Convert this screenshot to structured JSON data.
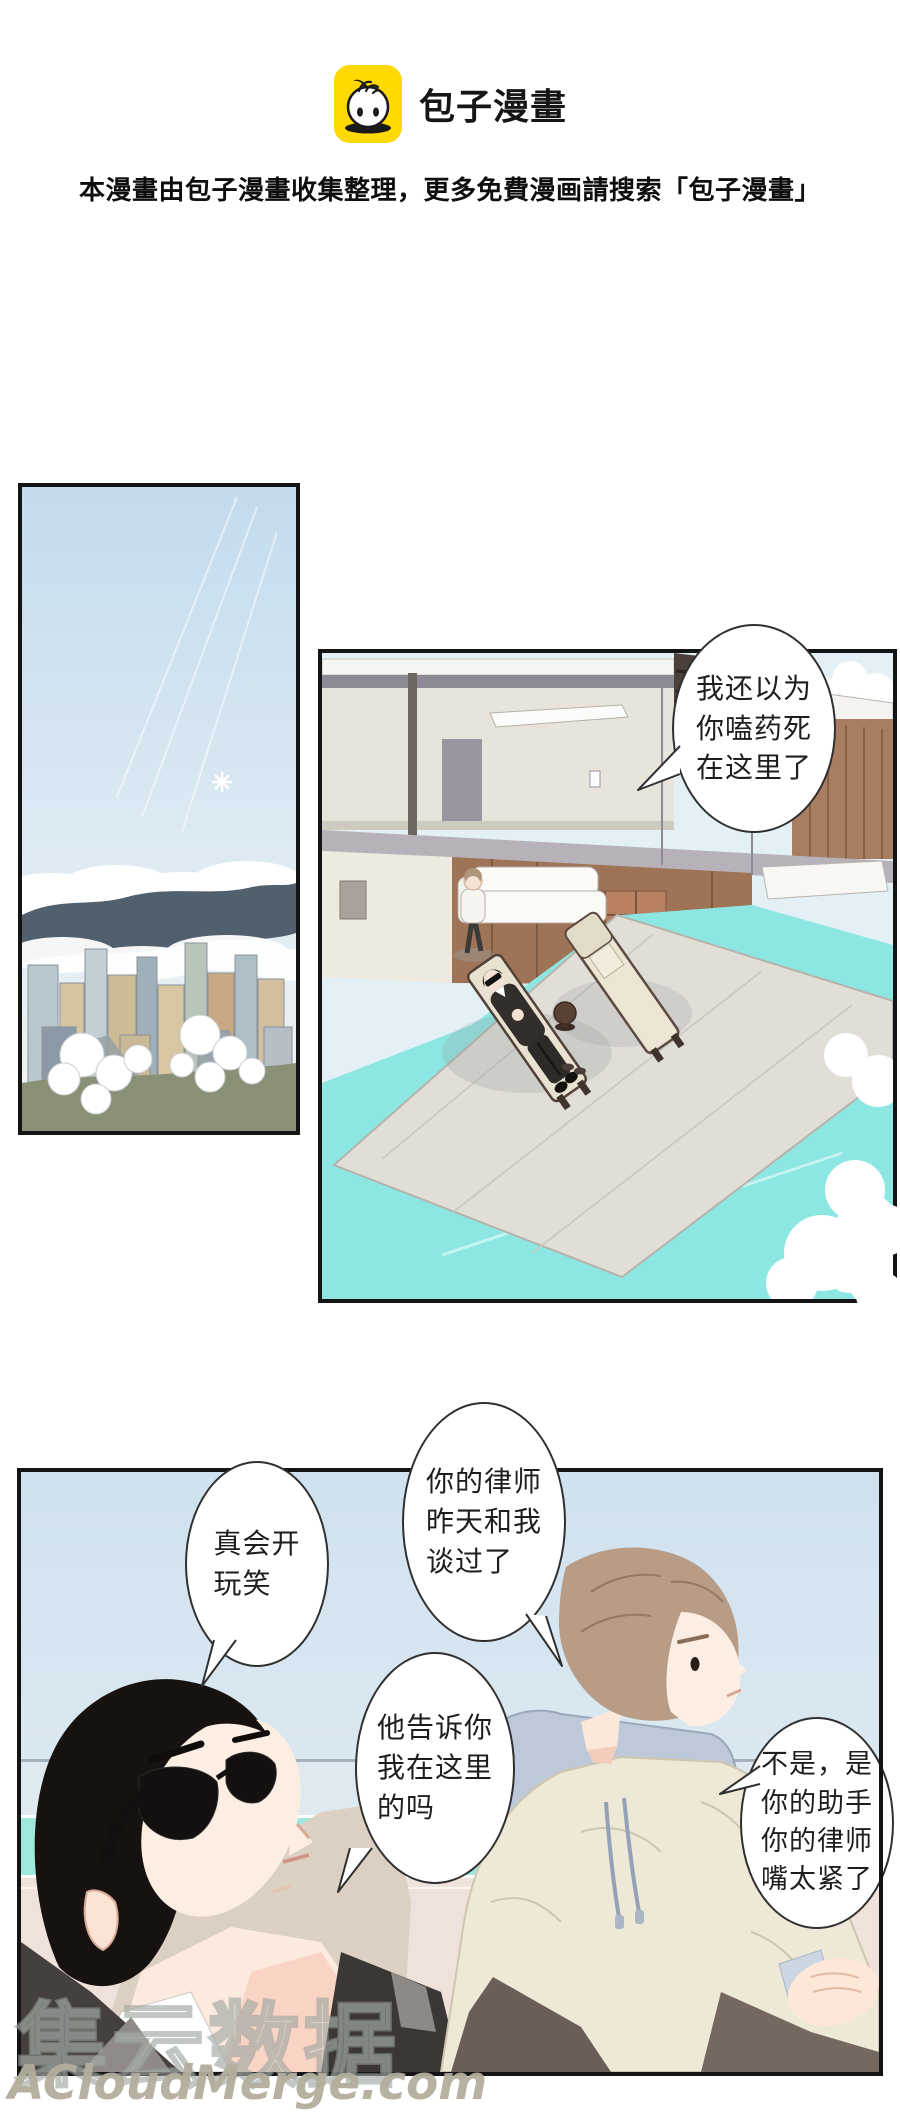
{
  "header": {
    "brand": "包子漫畫",
    "logo_icon": "baozi-mascot-icon",
    "logo_bg": "#FFD900",
    "subtitle": "本漫畫由包子漫畫收集整理，更多免費漫画請搜索「包子漫畫」"
  },
  "bubbles": {
    "pool_greeting": {
      "lines": [
        "我还以为",
        "你嗑药死",
        "在这里了"
      ]
    },
    "lawyer": {
      "lines": [
        "你的律师",
        "昨天和我",
        "谈过了"
      ]
    },
    "joke": {
      "lines": [
        "真会开",
        "玩笑"
      ]
    },
    "ask": {
      "lines": [
        "他告诉你",
        "我在这里",
        "的吗"
      ]
    },
    "assistant": {
      "lines": [
        "不是，是",
        "你的助手",
        "你的律师",
        "嘴太紧了"
      ]
    }
  },
  "watermark": {
    "brand_cn": "集云数据",
    "site": "ACloudMerge.com"
  },
  "art_colors": {
    "logo_yellow": "#FFD900",
    "pool_turquoise": "#8CE7E2",
    "sky_blue": "#D6E6F2",
    "deck_gray": "#E1DED7",
    "wood_brown": "#A57D61",
    "hair_black": "#17120F",
    "hair_brown": "#B99C85",
    "jacket_cream": "#EEE8D7",
    "hood_blue": "#BDC9D9"
  }
}
